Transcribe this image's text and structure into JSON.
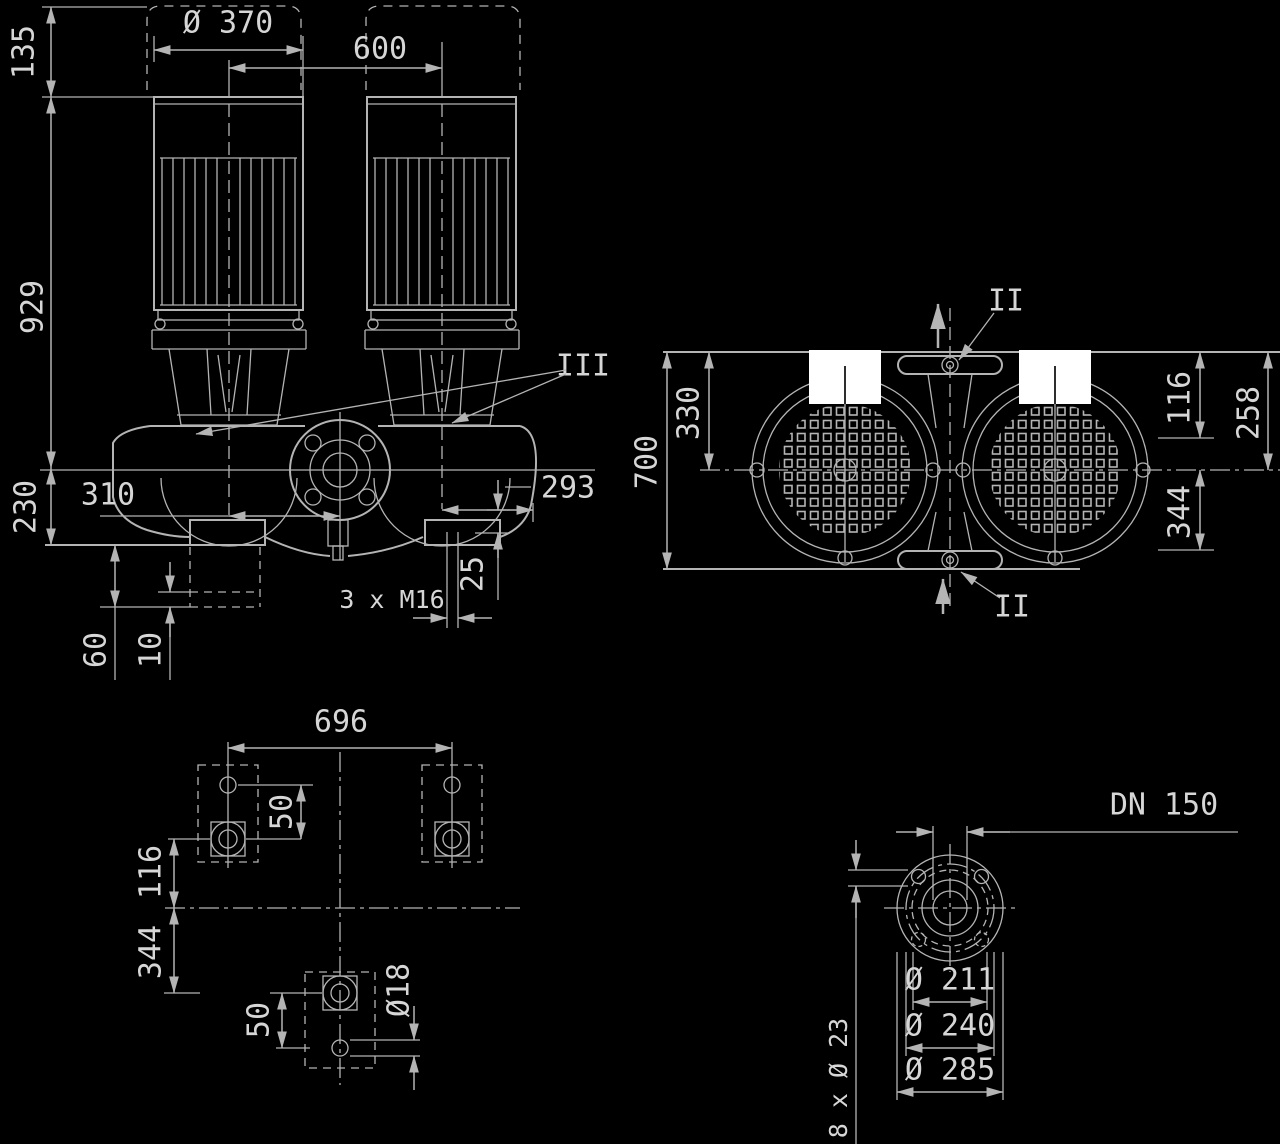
{
  "colors": {
    "background": "#000000",
    "line": "#b4b4b4",
    "text": "#d6d6d6",
    "terminal_box_fill": "#ffffff"
  },
  "front_view": {
    "lift_clearance": "135",
    "motor_diameter": "Ø 370",
    "motor_spacing": "600",
    "height_total": "929",
    "axis_to_base": "230",
    "center_to_left_motor": "310",
    "center_to_right_motor": "293",
    "base_step_height": "25",
    "foundation_bolts": "3 x M16",
    "foundation_height": "60",
    "grout_thickness": "10",
    "seal_section_label": "III"
  },
  "plan_view": {
    "depth_total": "700",
    "edge_to_pipe_axis": "330",
    "pipe_axis_to_cover": "116",
    "edge_to_pipe_axis_right": "258",
    "pipe_axis_to_foot": "344",
    "section_label_top": "II",
    "section_label_bottom": "II"
  },
  "foundation_plan": {
    "bolt_span": "696",
    "hole_pair_offset_top": "50",
    "feet_line_to_axis": "116",
    "axis_to_rear_foot": "344",
    "hole_pair_offset_bottom": "50",
    "anchor_hole_diameter": "Ø18"
  },
  "flange_detail": {
    "nominal_size": "DN 150",
    "raised_face_diameter": "Ø 211",
    "bolt_circle_diameter": "Ø 240",
    "flange_outer_diameter": "Ø 285",
    "bolt_holes": "8 x Ø 23"
  }
}
